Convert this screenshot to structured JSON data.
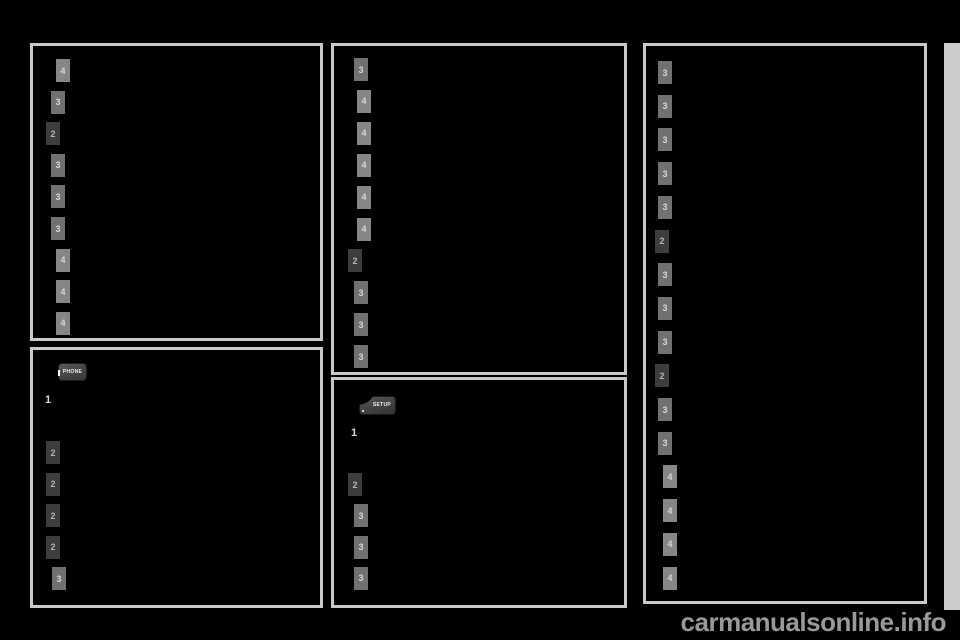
{
  "page": {
    "watermark": "carmanualsonline.info"
  },
  "colors": {
    "page_bg": "#000000",
    "box_border": "#c9c9c9",
    "badge_level2_bg": "#3d3d3d",
    "badge_level3_bg": "#717171",
    "badge_level4_bg": "#868686",
    "badge_text": "#d6d6d6",
    "side_tab": "#cccccc",
    "watermark": "#999999"
  },
  "boxes": [
    {
      "name": "toc-box-top-left",
      "items": [
        {
          "n": "4",
          "level": 4
        },
        {
          "n": "3",
          "level": 3
        },
        {
          "n": "2",
          "level": 2
        },
        {
          "n": "3",
          "level": 3
        },
        {
          "n": "3",
          "level": 3
        },
        {
          "n": "3",
          "level": 3
        },
        {
          "n": "4",
          "level": 4
        },
        {
          "n": "4",
          "level": 4
        },
        {
          "n": "4",
          "level": 4
        }
      ]
    },
    {
      "name": "toc-box-bottom-left",
      "button": {
        "label": "PHONE"
      },
      "list_marker": "1",
      "items": [
        {
          "n": "2",
          "level": 2
        },
        {
          "n": "2",
          "level": 2
        },
        {
          "n": "2",
          "level": 2
        },
        {
          "n": "2",
          "level": 2
        },
        {
          "n": "3",
          "level": 3
        }
      ]
    },
    {
      "name": "toc-box-top-middle",
      "items": [
        {
          "n": "3",
          "level": 3
        },
        {
          "n": "4",
          "level": 4
        },
        {
          "n": "4",
          "level": 4
        },
        {
          "n": "4",
          "level": 4
        },
        {
          "n": "4",
          "level": 4
        },
        {
          "n": "4",
          "level": 4
        },
        {
          "n": "2",
          "level": 2
        },
        {
          "n": "3",
          "level": 3
        },
        {
          "n": "3",
          "level": 3
        },
        {
          "n": "3",
          "level": 3
        }
      ]
    },
    {
      "name": "toc-box-bottom-middle",
      "button": {
        "label": "SETUP"
      },
      "list_marker": "1",
      "items": [
        {
          "n": "2",
          "level": 2
        },
        {
          "n": "3",
          "level": 3
        },
        {
          "n": "3",
          "level": 3
        },
        {
          "n": "3",
          "level": 3
        }
      ]
    },
    {
      "name": "toc-box-right",
      "items": [
        {
          "n": "3",
          "level": 3
        },
        {
          "n": "3",
          "level": 3
        },
        {
          "n": "3",
          "level": 3
        },
        {
          "n": "3",
          "level": 3
        },
        {
          "n": "3",
          "level": 3
        },
        {
          "n": "2",
          "level": 2
        },
        {
          "n": "3",
          "level": 3
        },
        {
          "n": "3",
          "level": 3
        },
        {
          "n": "3",
          "level": 3
        },
        {
          "n": "2",
          "level": 2
        },
        {
          "n": "3",
          "level": 3
        },
        {
          "n": "3",
          "level": 3
        },
        {
          "n": "4",
          "level": 4
        },
        {
          "n": "4",
          "level": 4
        },
        {
          "n": "4",
          "level": 4
        },
        {
          "n": "4",
          "level": 4
        }
      ]
    }
  ]
}
